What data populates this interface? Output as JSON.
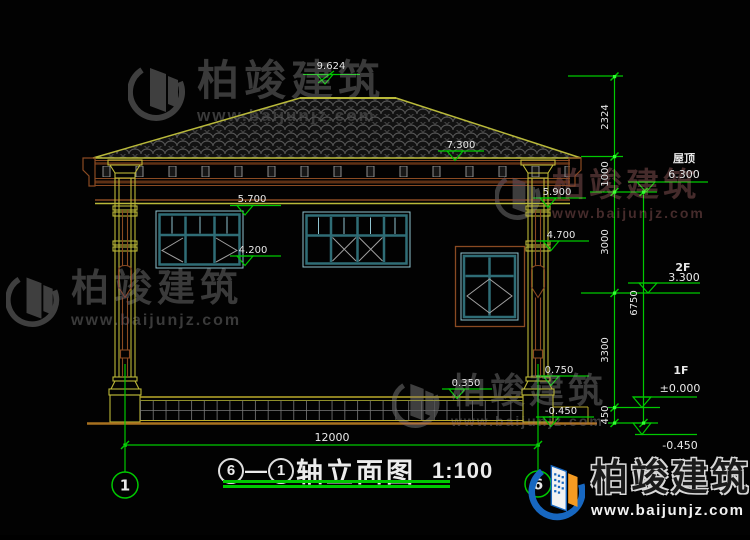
{
  "brand": {
    "name": "柏竣建筑",
    "url": "www.baijunjz.com"
  },
  "title": {
    "axis_right": "6",
    "dash": "—",
    "axis_left": "1",
    "name": "轴立面图",
    "scale": "1:100"
  },
  "levels": {
    "roof": {
      "label": "屋顶",
      "value": "6.300"
    },
    "f2": {
      "label": "2F",
      "value": "3.300"
    },
    "f1": {
      "label": "1F",
      "value": "±0.000"
    },
    "basement": {
      "value": "-0.450"
    }
  },
  "elevations": {
    "ridge": "9.624",
    "eave": "7.300",
    "lintel_2f": "5.700",
    "sill_2f": "4.200",
    "capital": "5.900",
    "ring": "4.700",
    "pedestal": "0.750",
    "terrace": "0.350",
    "ground": "-0.450"
  },
  "dimensions": {
    "ridge_to_eave": "2324",
    "eave_to_roof": "1000",
    "roof_to_2f": "3000",
    "f2_to_1f": "3300",
    "f1_to_ground": "450",
    "overall_height": "6750",
    "overall_width": "12000"
  },
  "axes": {
    "left": "1",
    "right": "6"
  }
}
